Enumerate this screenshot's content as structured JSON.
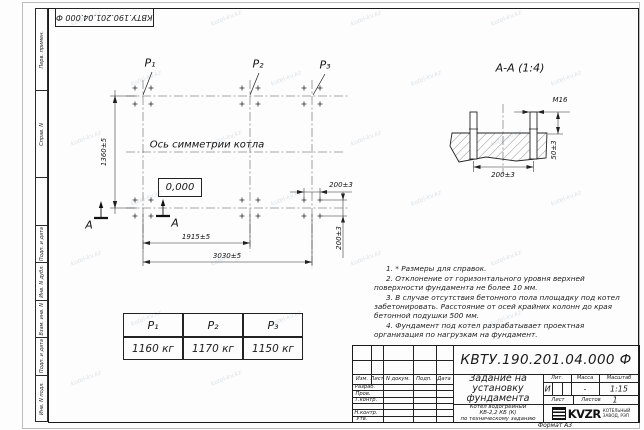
{
  "sheet": {
    "doc_number": "КВТУ.190.201.04.000 Ф",
    "format_label": "Формат А3",
    "watermark": "kotel-kv.kz",
    "margin_labels": [
      "Перв. примен.",
      "Справ. N",
      "Подп. и дата",
      "Инв. N дубл.",
      "Взам. инв. N",
      "Подп. и дата",
      "Инв. N подл."
    ]
  },
  "plan": {
    "point_labels": [
      "P₁",
      "P₂",
      "P₃"
    ],
    "symmetry_axis_label": "Ось симметрии котла",
    "level_mark": "0,000",
    "section_letter": "А",
    "dim_height": "1360±5",
    "dim_span_p1_p2": "1915±5",
    "dim_span_total": "3030±5",
    "dim_bolt_spacing_x": "200±3",
    "dim_bolt_spacing_y": "200±3"
  },
  "section_view": {
    "title": "А-А (1:4)",
    "thread_label": "М16",
    "dim_protrusion": "50±3",
    "dim_bolt_spacing": "200±3"
  },
  "notes": [
    "1. * Размеры для справок.",
    "2. Отклонение от горизонтального уровня верхней поверхности фундамента не более 10 мм.",
    "3. В случае отсутствия бетонного пола площадку под котел забетонировать. Расстояние от осей крайних колонн до края бетонной подушки 500 мм.",
    "4. Фундамент под котел разрабатывает проектная организация по нагрузкам на фундамент."
  ],
  "load_table": {
    "headers": [
      "P₁",
      "P₂",
      "P₃"
    ],
    "values": [
      "1160 кг",
      "1170 кг",
      "1150 кг"
    ]
  },
  "title_block": {
    "title": "Задание на установку фундамента",
    "product_lines": [
      "Котел водогрейный",
      "КВ-2,2 КБ (К)",
      "по техническому заданию"
    ],
    "rev_columns": [
      "Изм.",
      "Лист",
      "N докум.",
      "Подп.",
      "Дата"
    ],
    "roles": [
      "Разраб.",
      "Пров.",
      "Т.контр.",
      "Н.контр.",
      "Утв."
    ],
    "lit_headers": [
      "Лит.",
      "Масса",
      "Масштаб"
    ],
    "lit_value": "И",
    "mass_value": "-",
    "scale_value": "1:15",
    "sheet_label": "Лист",
    "sheets_label": "Листов",
    "sheets_value": "1",
    "company_logo": "KVZR",
    "company_name_lines": [
      "КОТЕЛЬНЫЙ",
      "ЗАВОД, РЭП"
    ]
  }
}
